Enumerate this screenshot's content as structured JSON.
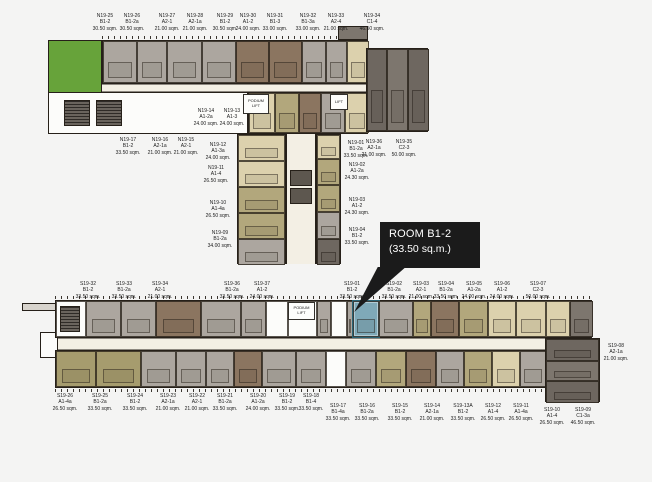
{
  "palette": {
    "background": "#f4f4f3",
    "wall": "#262019",
    "gray": "#aca69f",
    "brown": "#8b7560",
    "tan": "#b2a77c",
    "beige": "#dcd1ad",
    "khaki": "#a69c6e",
    "dark": "#6e6760",
    "white": "#fcfcfa",
    "teal_highlight": "#7fa9b8",
    "garden_green": "#67a33a",
    "corridor": "#f3efe4",
    "callout_bg": "#1b1b1b",
    "callout_text": "#ffffff"
  },
  "callout": {
    "room": "ROOM B1-2",
    "area": "(33.50 sq.m.)"
  },
  "highlight": {
    "unit": "S19-01",
    "type": "B1-2",
    "area": "33.50 sq.m.",
    "color": "#7fa9b8"
  },
  "lifts": {
    "podium": "PODIUM LIFT",
    "lift": "LIFT"
  },
  "north_building": {
    "name": "N19 tower floor plan",
    "labels": [
      {
        "unit": "N19-25",
        "type": "B1-2",
        "area": "30.50 sqm.",
        "x": 105,
        "y": 13
      },
      {
        "unit": "N19-26",
        "type": "B1-2a",
        "area": "30.50 sqm.",
        "x": 132,
        "y": 13
      },
      {
        "unit": "N19-27",
        "type": "A2-1",
        "area": "21.00 sqm.",
        "x": 167,
        "y": 13
      },
      {
        "unit": "N19-28",
        "type": "A2-1a",
        "area": "21.00 sqm.",
        "x": 195,
        "y": 13
      },
      {
        "unit": "N19-29",
        "type": "B1-2",
        "area": "30.50 sqm.",
        "x": 225,
        "y": 13
      },
      {
        "unit": "N19-30",
        "type": "A1-2",
        "area": "24.00 sqm.",
        "x": 248,
        "y": 13
      },
      {
        "unit": "N19-31",
        "type": "B1-3",
        "area": "33.00 sqm.",
        "x": 275,
        "y": 13
      },
      {
        "unit": "N19-32",
        "type": "B1-3a",
        "area": "33.00 sqm.",
        "x": 308,
        "y": 13
      },
      {
        "unit": "N19-33",
        "type": "A2-4",
        "area": "21.00 sqm.",
        "x": 336,
        "y": 13
      },
      {
        "unit": "N19-34",
        "type": "C1-4",
        "area": "46.50 sqm.",
        "x": 372,
        "y": 13
      },
      {
        "unit": "N19-17",
        "type": "B1-2",
        "area": "33.50 sqm.",
        "x": 128,
        "y": 137
      },
      {
        "unit": "N19-16",
        "type": "A2-1a",
        "area": "21.00 sqm.",
        "x": 160,
        "y": 137
      },
      {
        "unit": "N19-15",
        "type": "A2-1",
        "area": "21.00 sqm.",
        "x": 186,
        "y": 137
      },
      {
        "unit": "N19-14",
        "type": "A1-2a",
        "area": "24.00 sqm.",
        "x": 206,
        "y": 108
      },
      {
        "unit": "N19-13",
        "type": "A1-3",
        "area": "24.00 sqm.",
        "x": 232,
        "y": 108
      },
      {
        "unit": "N19-12",
        "type": "A1-3a",
        "area": "24.00 sqm.",
        "x": 218,
        "y": 142
      },
      {
        "unit": "N19-11",
        "type": "A1-4",
        "area": "26.50 sqm.",
        "x": 216,
        "y": 165
      },
      {
        "unit": "N19-10",
        "type": "A1-4a",
        "area": "26.50 sqm.",
        "x": 218,
        "y": 200
      },
      {
        "unit": "N19-09",
        "type": "B1-2a",
        "area": "34.00 sqm.",
        "x": 220,
        "y": 230
      },
      {
        "unit": "N19-01",
        "type": "B1-2a",
        "area": "33.50 sqm.",
        "x": 356,
        "y": 140
      },
      {
        "unit": "N19-02",
        "type": "A1-2a",
        "area": "24.30 sqm.",
        "x": 357,
        "y": 162
      },
      {
        "unit": "N19-03",
        "type": "A1-2",
        "area": "24.30 sqm.",
        "x": 357,
        "y": 197
      },
      {
        "unit": "N19-04",
        "type": "B1-2",
        "area": "33.50 sqm.",
        "x": 357,
        "y": 227
      },
      {
        "unit": "N19-36",
        "type": "A2-1a",
        "area": "21.00 sqm.",
        "x": 374,
        "y": 139
      },
      {
        "unit": "N19-35",
        "type": "C2-3",
        "area": "50.00 sqm.",
        "x": 404,
        "y": 139
      }
    ],
    "arm_top_units": [
      {
        "s": 34,
        "c": "gray"
      },
      {
        "s": 30,
        "c": "gray"
      },
      {
        "s": 35,
        "c": "gray"
      },
      {
        "s": 34,
        "c": "gray"
      },
      {
        "s": 33,
        "c": "brown"
      },
      {
        "s": 33,
        "c": "brown"
      },
      {
        "s": 24,
        "c": "gray"
      },
      {
        "s": 21,
        "c": "gray"
      },
      {
        "s": 22,
        "c": "beige"
      }
    ],
    "arm_bottom_units": [
      {
        "s": 26,
        "c": "beige"
      },
      {
        "s": 24,
        "c": "tan"
      },
      {
        "s": 22,
        "c": "brown"
      },
      {
        "s": 24,
        "c": "gray"
      },
      {
        "s": 24,
        "c": "beige"
      }
    ],
    "tail_units": [
      {
        "s": 20,
        "c": "dark"
      },
      {
        "s": 21,
        "c": "dark2"
      },
      {
        "s": 21,
        "c": "dark"
      }
    ],
    "stem_left_units": [
      {
        "s": 26,
        "c": "beige"
      },
      {
        "s": 26,
        "c": "beige"
      },
      {
        "s": 26,
        "c": "tan"
      },
      {
        "s": 26,
        "c": "tan"
      },
      {
        "s": 26,
        "c": "gray"
      }
    ],
    "stem_right_units": [
      {
        "s": 24,
        "c": "beige"
      },
      {
        "s": 26,
        "c": "tan"
      },
      {
        "s": 27,
        "c": "tan"
      },
      {
        "s": 27,
        "c": "gray"
      },
      {
        "s": 26,
        "c": "dark"
      }
    ]
  },
  "south_building": {
    "name": "S19 tower floor plan",
    "labels": [
      {
        "unit": "S19-32",
        "type": "B1-2",
        "area": "33.50 sqm.",
        "x": 88,
        "y": 281
      },
      {
        "unit": "S19-33",
        "type": "B1-2a",
        "area": "33.50 sqm.",
        "x": 124,
        "y": 281
      },
      {
        "unit": "S19-34",
        "type": "A2-1",
        "area": "21.00 sqm.",
        "x": 160,
        "y": 281
      },
      {
        "unit": "S19-36",
        "type": "B1-2a",
        "area": "33.50 sqm.",
        "x": 232,
        "y": 281
      },
      {
        "unit": "S19-37",
        "type": "A1-2",
        "area": "24.00 sqm.",
        "x": 262,
        "y": 281
      },
      {
        "unit": "S19-01",
        "type": "B1-2",
        "area": "33.50 sqm.",
        "x": 352,
        "y": 281
      },
      {
        "unit": "S19-02",
        "type": "B1-2a",
        "area": "33.50 sqm.",
        "x": 394,
        "y": 281
      },
      {
        "unit": "S19-03",
        "type": "A2-1",
        "area": "21.00 sqm.",
        "x": 421,
        "y": 281
      },
      {
        "unit": "S19-04",
        "type": "B1-2a",
        "area": "33.50 sqm.",
        "x": 446,
        "y": 281
      },
      {
        "unit": "S19-05",
        "type": "A1-2a",
        "area": "24.00 sqm.",
        "x": 474,
        "y": 281
      },
      {
        "unit": "S19-06",
        "type": "A1-2",
        "area": "24.00 sqm.",
        "x": 502,
        "y": 281
      },
      {
        "unit": "S19-07",
        "type": "C2-3",
        "area": "50.00 sqm.",
        "x": 538,
        "y": 281
      },
      {
        "unit": "S19-08",
        "type": "A2-1a",
        "area": "21.00 sqm.",
        "x": 616,
        "y": 343
      },
      {
        "unit": "S19-26",
        "type": "A1-4a",
        "area": "26.50 sqm.",
        "x": 65,
        "y": 393
      },
      {
        "unit": "S19-25",
        "type": "B1-2a",
        "area": "33.50 sqm.",
        "x": 100,
        "y": 393
      },
      {
        "unit": "S19-24",
        "type": "B1-2",
        "area": "33.50 sqm.",
        "x": 135,
        "y": 393
      },
      {
        "unit": "S19-23",
        "type": "A2-1a",
        "area": "21.00 sqm.",
        "x": 168,
        "y": 393
      },
      {
        "unit": "S19-22",
        "type": "A2-1",
        "area": "21.00 sqm.",
        "x": 197,
        "y": 393
      },
      {
        "unit": "S19-21",
        "type": "B1-2a",
        "area": "33.50 sqm.",
        "x": 225,
        "y": 393
      },
      {
        "unit": "S19-20",
        "type": "A1-2a",
        "area": "24.00 sqm.",
        "x": 258,
        "y": 393
      },
      {
        "unit": "S19-19",
        "type": "B1-2",
        "area": "33.50 sqm.",
        "x": 287,
        "y": 393
      },
      {
        "unit": "S19-18",
        "type": "B1-4",
        "area": "33.50 sqm.",
        "x": 311,
        "y": 393
      },
      {
        "unit": "S19-17",
        "type": "B1-4a",
        "area": "33.50 sqm.",
        "x": 338,
        "y": 403
      },
      {
        "unit": "S19-16",
        "type": "B1-2a",
        "area": "33.50 sqm.",
        "x": 367,
        "y": 403
      },
      {
        "unit": "S19-15",
        "type": "B1-2",
        "area": "33.50 sqm.",
        "x": 400,
        "y": 403
      },
      {
        "unit": "S19-14",
        "type": "A2-1a",
        "area": "21.00 sqm.",
        "x": 432,
        "y": 403
      },
      {
        "unit": "S19-13A",
        "type": "B1-2",
        "area": "33.50 sqm.",
        "x": 463,
        "y": 403
      },
      {
        "unit": "S19-12",
        "type": "A1-4",
        "area": "26.50 sqm.",
        "x": 493,
        "y": 403
      },
      {
        "unit": "S19-11",
        "type": "A1-4a",
        "area": "26.50 sqm.",
        "x": 521,
        "y": 403
      },
      {
        "unit": "S19-10",
        "type": "A1-4",
        "area": "26.50 sqm.",
        "x": 552,
        "y": 407
      },
      {
        "unit": "S19-09",
        "type": "C1-3a",
        "area": "46.50 sqm.",
        "x": 583,
        "y": 407
      }
    ],
    "top_row_units": [
      {
        "s": 30,
        "c": "white"
      },
      {
        "s": 35,
        "c": "gray"
      },
      {
        "s": 35,
        "c": "gray"
      },
      {
        "s": 45,
        "c": "brown"
      },
      {
        "s": 40,
        "c": "gray"
      },
      {
        "s": 25,
        "c": "gray"
      },
      {
        "s": 22,
        "c": "white"
      },
      {
        "s": 29,
        "c": "white"
      },
      {
        "s": 14,
        "c": "gray"
      },
      {
        "s": 16,
        "c": "white"
      },
      {
        "s": 6,
        "c": "gray"
      },
      {
        "s": 26,
        "c": "teal",
        "hl": true,
        "name": "room-S19-01-highlighted"
      },
      {
        "s": 34,
        "c": "gray"
      },
      {
        "s": 18,
        "c": "tan"
      },
      {
        "s": 28,
        "c": "brown"
      },
      {
        "s": 29,
        "c": "tan"
      },
      {
        "s": 28,
        "c": "beige"
      },
      {
        "s": 30,
        "c": "beige"
      },
      {
        "s": 24,
        "c": "beige"
      },
      {
        "s": 23,
        "c": "dark2"
      }
    ],
    "bottom_row_units": [
      {
        "s": 40,
        "c": "khaki"
      },
      {
        "s": 45,
        "c": "khaki"
      },
      {
        "s": 35,
        "c": "gray"
      },
      {
        "s": 30,
        "c": "gray"
      },
      {
        "s": 28,
        "c": "gray"
      },
      {
        "s": 28,
        "c": "brown"
      },
      {
        "s": 34,
        "c": "gray"
      },
      {
        "s": 30,
        "c": "gray"
      },
      {
        "s": 20,
        "c": "white"
      },
      {
        "s": 30,
        "c": "gray"
      },
      {
        "s": 30,
        "c": "tan"
      },
      {
        "s": 30,
        "c": "brown"
      },
      {
        "s": 28,
        "c": "gray"
      },
      {
        "s": 28,
        "c": "tan"
      },
      {
        "s": 28,
        "c": "beige"
      },
      {
        "s": 26,
        "c": "gray"
      }
    ],
    "corner_units": [
      {
        "s": 22,
        "c": "dark"
      },
      {
        "s": 20,
        "c": "dark2"
      },
      {
        "s": 22,
        "c": "dark"
      }
    ]
  }
}
